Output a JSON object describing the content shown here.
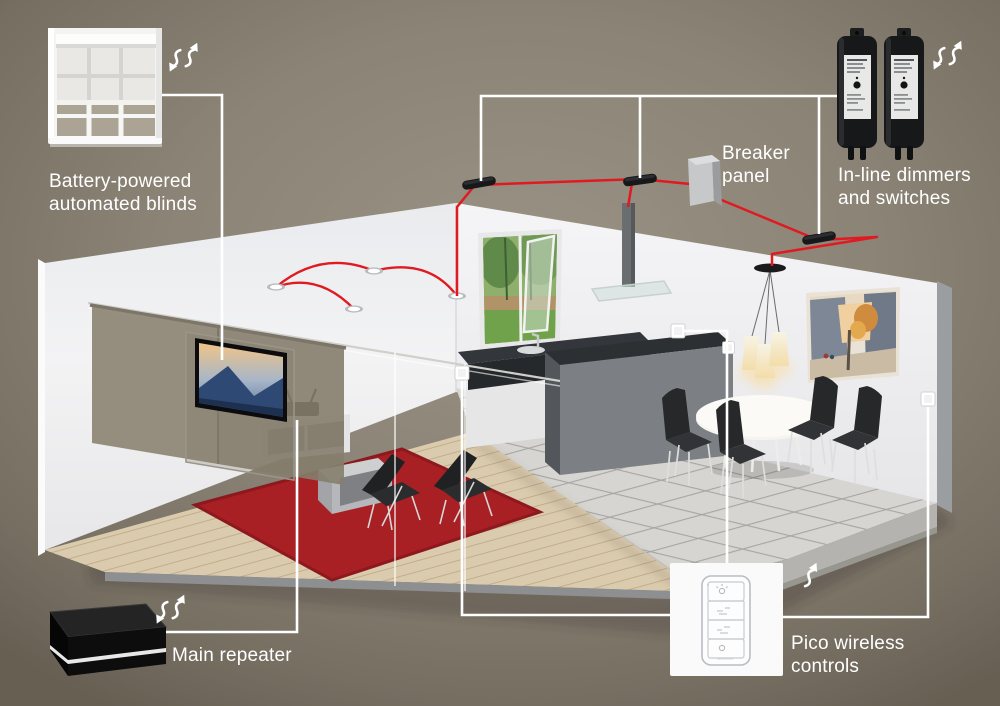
{
  "callouts": {
    "blinds": {
      "label": "Battery-powered\nautomated blinds",
      "icon": "wireless-signal-icon"
    },
    "breaker": {
      "label": "Breaker\npanel"
    },
    "dimmers": {
      "label": "In-line dimmers\nand switches",
      "icon": "wireless-signal-icon"
    },
    "repeater": {
      "label": "Main repeater",
      "icon": "wireless-signal-icon"
    },
    "pico": {
      "label": "Pico wireless\ncontrols",
      "icon": "wireless-signal-icon"
    }
  },
  "colors": {
    "background_center": "#9a9284",
    "background_edge": "#685f53",
    "wire_red": "#e01a20",
    "label_line_white": "#ffffff",
    "rug_red": "#a81f24",
    "device_black": "#17181a",
    "wall_white": "#f2f2f4",
    "text": "#ffffff"
  },
  "icons": [
    "wireless-signal-icon",
    "recessed-light-icon",
    "inline-dimmer-module",
    "breaker-panel-box",
    "pico-remote",
    "wall-switch"
  ]
}
